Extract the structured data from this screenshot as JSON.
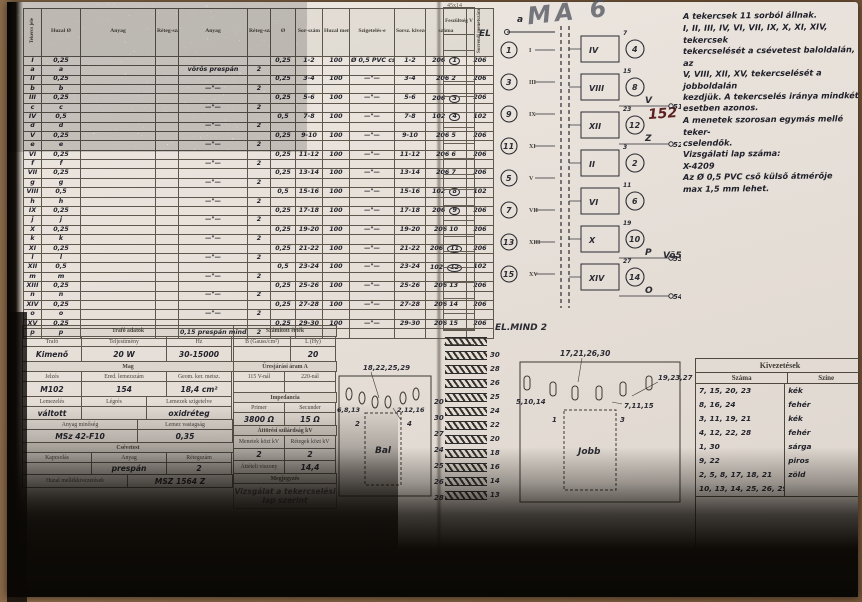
{
  "misc": {
    "corner_note": "45x14",
    "scribble": "MA 6",
    "red_note": "152",
    "vo_note": "Vö5",
    "fesz_header": "Feszültség V"
  },
  "main_table": {
    "headers": [
      "Tekercs jele",
      "Huzal Ø",
      "Anyag",
      "Réteg-szám",
      "Anyag",
      "Réteg-szám",
      "Ø",
      "Sor-szám",
      "Huzal menetben",
      "Szigetelés-e",
      "Sorsz. kivezetés jelei",
      "száma",
      "Sorrendi menetszám"
    ],
    "rows": [
      {
        "jele": "I",
        "huzal": "0,25",
        "dia": "0,25",
        "sorszam": "1-2",
        "menet": "100",
        "szig": "Ø 0,5 PVC cső",
        "kivjel": "1-2",
        "szama": "206",
        "idx": "1",
        "circled": true,
        "sorrend": "206"
      },
      {
        "jele": "a",
        "huzal": "a",
        "anyag2": "vörös prespán",
        "reteg2": "2"
      },
      {
        "jele": "II",
        "huzal": "0,25",
        "dia": "0,25",
        "sorszam": "3-4",
        "menet": "100",
        "szig": "—\"—",
        "kivjel": "3-4",
        "szama": "206",
        "idx": "2",
        "circled": false,
        "sorrend": "206"
      },
      {
        "jele": "b",
        "huzal": "b",
        "anyag2": "—\"—",
        "reteg2": "2"
      },
      {
        "jele": "III",
        "huzal": "0,25",
        "dia": "0,25",
        "sorszam": "5-6",
        "menet": "100",
        "szig": "—\"—",
        "kivjel": "5-6",
        "szama": "206",
        "idx": "3",
        "circled": true,
        "sorrend": "206"
      },
      {
        "jele": "c",
        "huzal": "c",
        "anyag2": "—\"—",
        "reteg2": "2"
      },
      {
        "jele": "IV",
        "huzal": "0,5",
        "dia": "0,5",
        "sorszam": "7-8",
        "menet": "100",
        "szig": "—\"—",
        "kivjel": "7-8",
        "szama": "102",
        "idx": "4",
        "circled": true,
        "sorrend": "102"
      },
      {
        "jele": "d",
        "huzal": "d",
        "anyag2": "—\"—",
        "reteg2": "2"
      },
      {
        "jele": "V",
        "huzal": "0,25",
        "dia": "0,25",
        "sorszam": "9-10",
        "menet": "100",
        "szig": "—\"—",
        "kivjel": "9-10",
        "szama": "206",
        "idx": "5",
        "circled": false,
        "sorrend": "206"
      },
      {
        "jele": "e",
        "huzal": "e",
        "anyag2": "—\"—",
        "reteg2": "2"
      },
      {
        "jele": "VI",
        "huzal": "0,25",
        "dia": "0,25",
        "sorszam": "11-12",
        "menet": "100",
        "szig": "—\"—",
        "kivjel": "11-12",
        "szama": "206",
        "idx": "6",
        "circled": false,
        "sorrend": "206"
      },
      {
        "jele": "f",
        "huzal": "f",
        "anyag2": "—\"—",
        "reteg2": "2"
      },
      {
        "jele": "VII",
        "huzal": "0,25",
        "dia": "0,25",
        "sorszam": "13-14",
        "menet": "100",
        "szig": "—\"—",
        "kivjel": "13-14",
        "szama": "206",
        "idx": "7",
        "circled": false,
        "sorrend": "206"
      },
      {
        "jele": "g",
        "huzal": "g",
        "anyag2": "—\"—",
        "reteg2": "2"
      },
      {
        "jele": "VIII",
        "huzal": "0,5",
        "dia": "0,5",
        "sorszam": "15-16",
        "menet": "100",
        "szig": "—\"—",
        "kivjel": "15-16",
        "szama": "102",
        "idx": "8",
        "circled": true,
        "sorrend": "102"
      },
      {
        "jele": "h",
        "huzal": "h",
        "anyag2": "—\"—",
        "reteg2": "2"
      },
      {
        "jele": "IX",
        "huzal": "0,25",
        "dia": "0,25",
        "sorszam": "17-18",
        "menet": "100",
        "szig": "—\"—",
        "kivjel": "17-18",
        "szama": "206",
        "idx": "9",
        "circled": true,
        "sorrend": "206"
      },
      {
        "jele": "j",
        "huzal": "j",
        "anyag2": "—\"—",
        "reteg2": "2"
      },
      {
        "jele": "X",
        "huzal": "0,25",
        "dia": "0,25",
        "sorszam": "19-20",
        "menet": "100",
        "szig": "—\"—",
        "kivjel": "19-20",
        "szama": "206",
        "idx": "10",
        "circled": false,
        "sorrend": "206"
      },
      {
        "jele": "k",
        "huzal": "k",
        "anyag2": "—\"—",
        "reteg2": "2"
      },
      {
        "jele": "XI",
        "huzal": "0,25",
        "dia": "0,25",
        "sorszam": "21-22",
        "menet": "100",
        "szig": "—\"—",
        "kivjel": "21-22",
        "szama": "206",
        "idx": "11",
        "circled": true,
        "sorrend": "206"
      },
      {
        "jele": "l",
        "huzal": "l",
        "anyag2": "—\"—",
        "reteg2": "2"
      },
      {
        "jele": "XII",
        "huzal": "0,5",
        "dia": "0,5",
        "sorszam": "23-24",
        "menet": "100",
        "szig": "—\"—",
        "kivjel": "23-24",
        "szama": "102",
        "idx": "12",
        "circled": true,
        "sorrend": "102"
      },
      {
        "jele": "m",
        "huzal": "m",
        "anyag2": "—\"—",
        "reteg2": "2"
      },
      {
        "jele": "XIII",
        "huzal": "0,25",
        "dia": "0,25",
        "sorszam": "25-26",
        "menet": "100",
        "szig": "—\"—",
        "kivjel": "25-26",
        "szama": "206",
        "idx": "13",
        "circled": false,
        "sorrend": "206"
      },
      {
        "jele": "n",
        "huzal": "n",
        "anyag2": "—\"—",
        "reteg2": "2"
      },
      {
        "jele": "XIV",
        "huzal": "0,25",
        "dia": "0,25",
        "sorszam": "27-28",
        "menet": "100",
        "szig": "—\"—",
        "kivjel": "27-28",
        "szama": "206",
        "idx": "14",
        "circled": false,
        "sorrend": "206"
      },
      {
        "jele": "o",
        "huzal": "o",
        "anyag2": "—\"—",
        "reteg2": "2"
      },
      {
        "jele": "XV",
        "huzal": "0,25",
        "dia": "0,25",
        "sorszam": "29-30",
        "menet": "100",
        "szig": "—\"—",
        "kivjel": "29-30",
        "szama": "206",
        "idx": "15",
        "circled": false,
        "sorrend": "206"
      },
      {
        "jele": "p",
        "huzal": "p",
        "anyag2": "0,15 prespán mindkét részen",
        "reteg2": "2"
      }
    ]
  },
  "trafo": {
    "title": "Trafó adatok",
    "r1_labels": [
      "Trafó",
      "Teljesítmény",
      "Hz"
    ],
    "r1_values": [
      "Kimenő",
      "20 W",
      "30-15000"
    ],
    "mag_band": "Mag",
    "r2_labels": [
      "Jelzés",
      "Ered. lemezszám",
      "Geom. ker. metsz."
    ],
    "r2_values": [
      "M102",
      "154",
      "18,4 cm²"
    ],
    "r3_labels": [
      "Lemezelés",
      "Légrés",
      "Lemezek szigetelve"
    ],
    "r3_values": [
      "váltott",
      "",
      "oxidréteg"
    ],
    "r4_labels": [
      "Anyag minőség",
      "Lemez vastagság"
    ],
    "r4_values": [
      "MSz 42-F10",
      "0,35"
    ],
    "csev_band": "Csévetest",
    "r5_labels": [
      "Kapcsolás",
      "Anyag",
      "Rétegszám"
    ],
    "r5_values": [
      "",
      "prespán",
      "2"
    ],
    "r6_label": "Huzal mellékkivezetések",
    "r6_value": "MSZ 1564 Z"
  },
  "szamitott": {
    "title": "Számított érték",
    "r1_labels": [
      "B (Gauss/cm²)",
      "L (Hy)"
    ],
    "r1_values": [
      "",
      "20"
    ],
    "ures_band": "Üresjárási áram A",
    "r2_labels": [
      "115 V-nál",
      "220-nál"
    ],
    "r2_values": [
      "",
      ""
    ],
    "imp_band": "Impedancia",
    "r3_labels": [
      "Primer",
      "Secunder"
    ],
    "r3_values": [
      "3800 Ω",
      "15 Ω"
    ],
    "att_band": "Áttörési szilárdság kV",
    "r4_labels": [
      "Menetek közt kV",
      "Rétegek közt kV"
    ],
    "r4_values": [
      "2",
      "2"
    ],
    "attetel_label": "Áttételi viszony",
    "attetel_value": "14,4",
    "megj_band": "Megjegyzés",
    "megj_text": "Vizsgálat a tekercselési lap szerint"
  },
  "notes": {
    "lines": [
      "A tekercsek 11 sorból állnak.",
      "I, II, III, IV, VI, VII, IX, X, XI, XIV, tekercsek",
      "tekercselését a csévetest baloldalán, az",
      "V, VIII, XII, XV, tekercselését a jobboldalán",
      "kezdjük. A tekercselés iránya mindkét",
      "esetben azonos.",
      "A menetek szorosan egymás mellé teker-",
      "cselendők.",
      "Vizsgálati lap száma:",
      "X-4209",
      "Az Ø 0,5 PVC cső külső átmérője",
      "max 1,5 mm lehet."
    ]
  },
  "schematic": {
    "el_label": "EL",
    "el2_label": "EL.MIND 2",
    "top_letter": "a",
    "left_circles": [
      {
        "num": "1",
        "roman": "I"
      },
      {
        "num": "3",
        "roman": "III"
      },
      {
        "num": "9",
        "roman": "IX"
      },
      {
        "num": "11",
        "roman": "XI"
      },
      {
        "num": "5",
        "roman": "V"
      },
      {
        "num": "7",
        "roman": "VII"
      },
      {
        "num": "13",
        "roman": "XIII"
      },
      {
        "num": "15",
        "roman": "XV"
      }
    ],
    "blocks": [
      {
        "roman": "IV",
        "circle": "4",
        "pin": "7"
      },
      {
        "roman": "VIII",
        "circle": "8",
        "pin": "15"
      },
      {
        "roman": "XII",
        "circle": "12",
        "pin": "23"
      },
      {
        "roman": "II",
        "circle": "2",
        "pin": "3"
      },
      {
        "roman": "VI",
        "circle": "6",
        "pin": "11"
      },
      {
        "roman": "X",
        "circle": "10",
        "pin": "19"
      },
      {
        "roman": "XIV",
        "circle": "14",
        "pin": "27"
      }
    ],
    "terminals": [
      {
        "wire": "V",
        "num": "51",
        "after_block": 1
      },
      {
        "wire": "Z",
        "num": "52",
        "after_block": 2
      },
      {
        "wire": "P",
        "num": "53",
        "after_block": 5
      },
      {
        "wire": "O",
        "num": "54",
        "after_block": 6
      }
    ]
  },
  "strip": {
    "numbers": [
      "",
      "30",
      "28",
      "26",
      "25",
      "24",
      "22",
      "20",
      "18",
      "16",
      "14",
      "13"
    ]
  },
  "bal_bobbin": {
    "name": "Bal",
    "top_label": "18,22,25,29",
    "left_label": "6,8,13",
    "right_label": "2,12,16",
    "leg_left": "2",
    "leg_right": "4",
    "side_numbers": [
      "20",
      "30",
      "27",
      "24",
      "25",
      "26",
      "28"
    ]
  },
  "jobb_bobbin": {
    "name": "Jobb",
    "top_label": "17,21,26,30",
    "left_label": "5,10,14",
    "right_label": "7,11,15",
    "upper_right_label": "19,23,27",
    "leg_left": "1",
    "leg_right": "3"
  },
  "kivezetesek": {
    "title": "Kivezetések",
    "col1": "Száma",
    "col2": "Színe",
    "rows": [
      {
        "szama": "7, 15, 20, 23",
        "szine": "kék"
      },
      {
        "szama": "8, 16, 24",
        "szine": "fehér"
      },
      {
        "szama": "3, 11, 19, 21",
        "szine": "kék"
      },
      {
        "szama": "4, 12, 22, 28",
        "szine": "fehér"
      },
      {
        "szama": "1, 30",
        "szine": "sárga"
      },
      {
        "szama": "9, 22",
        "szine": "piros"
      },
      {
        "szama": "2, 5, 8, 17, 18, 21",
        "szine": "zöld"
      },
      {
        "szama": "10, 13, 14, 25, 26, 29",
        "szine": ""
      }
    ]
  }
}
